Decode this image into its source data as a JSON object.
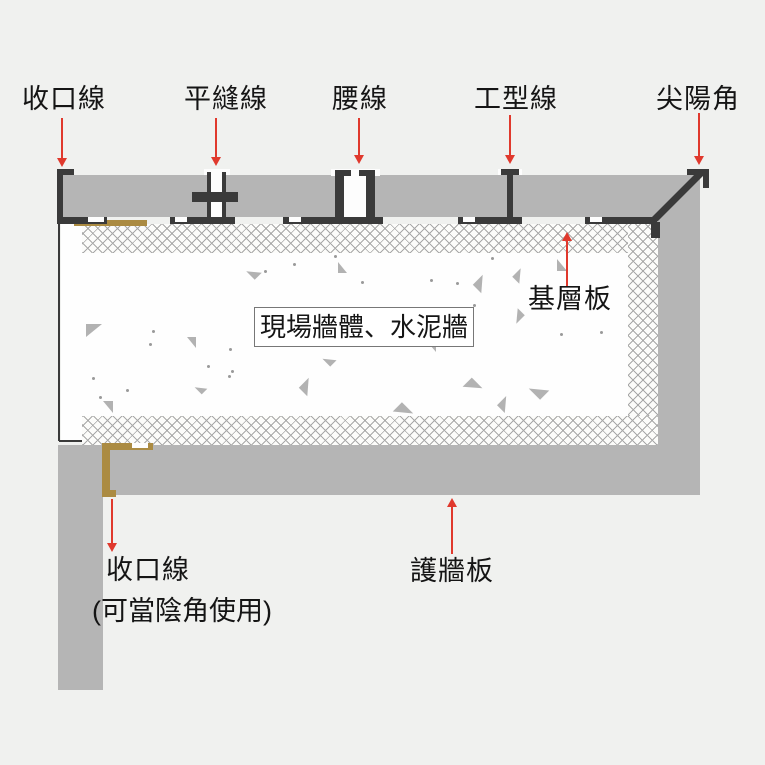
{
  "diagram": {
    "type": "wall-panel installation cross-section",
    "colors": {
      "background": "#f0f1ef",
      "panel_gray": "#b5b5b5",
      "profile_black": "#3a3a3a",
      "gold_profile": "#ab8b42",
      "arrow_red": "#e0392d",
      "text": "#151515"
    },
    "callouts_top": [
      {
        "label": "收口線"
      },
      {
        "label": "平縫線"
      },
      {
        "label": "腰線"
      },
      {
        "label": "工型線"
      },
      {
        "label": "尖陽角"
      }
    ],
    "callouts": {
      "base_layer_board": "基層板",
      "site_wall": "現場牆體、水泥牆",
      "wall_guard_board": "護牆板",
      "closing_line_bottom": "收口線",
      "closing_line_note": "(可當陰角使用)"
    }
  }
}
